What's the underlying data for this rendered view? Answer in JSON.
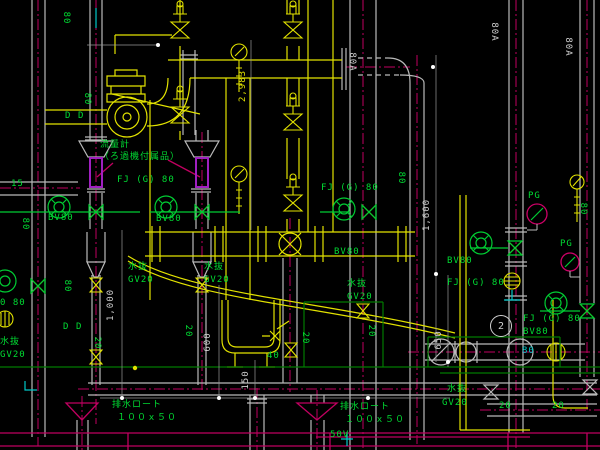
{
  "colors": {
    "background": "#000000",
    "piping_yellow": "#e2e200",
    "pipe_gray": "#b9b9b9",
    "centerline_magenta": "#c00060",
    "annotation_green": "#00dd33",
    "dimension_white": "#cfcfcf",
    "spool_purple": "#a020c0",
    "foundation_green": "#007a00",
    "cyan": "#00c8c8"
  },
  "labels": [
    {
      "kind": "equipment",
      "text": "流量計"
    },
    {
      "kind": "equipment",
      "text": "（ろ過機付属品）"
    },
    {
      "kind": "valve",
      "text": "FJ (G) 80"
    },
    {
      "kind": "valve",
      "text": "BV80"
    },
    {
      "kind": "valve",
      "text": "BV80"
    },
    {
      "kind": "valve",
      "text": "FJ (G) 80"
    },
    {
      "kind": "valve",
      "text": "BV80"
    },
    {
      "kind": "drain",
      "text": "水抜"
    },
    {
      "kind": "drain",
      "text": "GV20"
    },
    {
      "kind": "drain",
      "text": "水抜"
    },
    {
      "kind": "drain",
      "text": "GV20"
    },
    {
      "kind": "drain",
      "text": "水抜"
    },
    {
      "kind": "drain",
      "text": "GV20"
    },
    {
      "kind": "drain",
      "text": "水抜"
    },
    {
      "kind": "drain",
      "text": "GV20"
    },
    {
      "kind": "drain",
      "text": "水抜"
    },
    {
      "kind": "drain",
      "text": "GV20"
    },
    {
      "kind": "valve",
      "text": "BV80"
    },
    {
      "kind": "valve",
      "text": "FJ (G) 80"
    },
    {
      "kind": "gauge",
      "text": "PG"
    },
    {
      "kind": "gauge",
      "text": "PG"
    },
    {
      "kind": "valve",
      "text": "FJ (G) 80"
    },
    {
      "kind": "valve",
      "text": "BV80"
    },
    {
      "kind": "drain",
      "text": "排水ロート"
    },
    {
      "kind": "drain",
      "text": "１００ｘ５０"
    },
    {
      "kind": "drain",
      "text": "排水ロート"
    },
    {
      "kind": "drain",
      "text": "１００ｘ５０"
    },
    {
      "kind": "size",
      "text": "50V"
    },
    {
      "kind": "size",
      "text": "40"
    },
    {
      "kind": "size",
      "text": "15"
    },
    {
      "kind": "size",
      "text": "20"
    },
    {
      "kind": "size",
      "text": "20"
    },
    {
      "kind": "size",
      "text": "0 80"
    },
    {
      "kind": "size",
      "text": "80"
    },
    {
      "kind": "size",
      "text": "80"
    },
    {
      "kind": "size",
      "text": "80"
    },
    {
      "kind": "size",
      "text": "80"
    },
    {
      "kind": "size",
      "text": "20"
    },
    {
      "kind": "size",
      "text": "20"
    },
    {
      "kind": "size",
      "text": "20"
    },
    {
      "kind": "size",
      "text": "20"
    },
    {
      "kind": "size",
      "text": "80"
    },
    {
      "kind": "size",
      "text": "80"
    },
    {
      "kind": "mark",
      "text": "D"
    },
    {
      "kind": "mark",
      "text": "D"
    },
    {
      "kind": "mark",
      "text": "D"
    },
    {
      "kind": "mark",
      "text": "D"
    },
    {
      "kind": "size",
      "text": "80"
    },
    {
      "kind": "pipe-size",
      "text": "80A"
    },
    {
      "kind": "pipe-size",
      "text": "80A"
    },
    {
      "kind": "pipe-size",
      "text": "80A"
    },
    {
      "kind": "dimension",
      "text": "2,983"
    },
    {
      "kind": "dimension",
      "text": "1,600"
    },
    {
      "kind": "dimension",
      "text": "1,000"
    },
    {
      "kind": "dimension",
      "text": "600"
    },
    {
      "kind": "dimension",
      "text": "150"
    },
    {
      "kind": "dimension",
      "text": "650"
    },
    {
      "kind": "balloon",
      "text": "2"
    }
  ]
}
